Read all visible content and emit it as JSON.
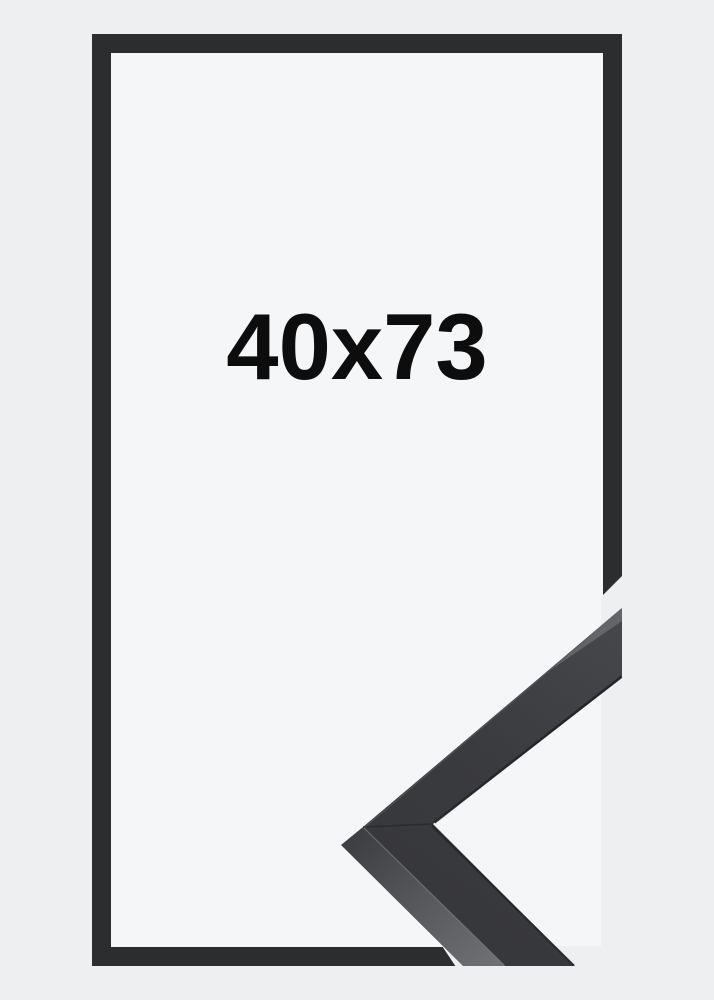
{
  "product": {
    "size_label": "40x73",
    "colors": {
      "page_background": "#eeeff0",
      "frame_interior_background": "#f5f6f7",
      "frame_outline": "#2c2d2e",
      "moulding_face": "#3d3e41",
      "moulding_side": "#5f6164",
      "label_text": "#0d0d0d"
    },
    "graphics": [
      {
        "name": "frame-outline",
        "description": "thin dark rectangular frame border"
      },
      {
        "name": "corner-detail-photo",
        "description": "close-up of black frame moulding corner profile"
      }
    ]
  }
}
